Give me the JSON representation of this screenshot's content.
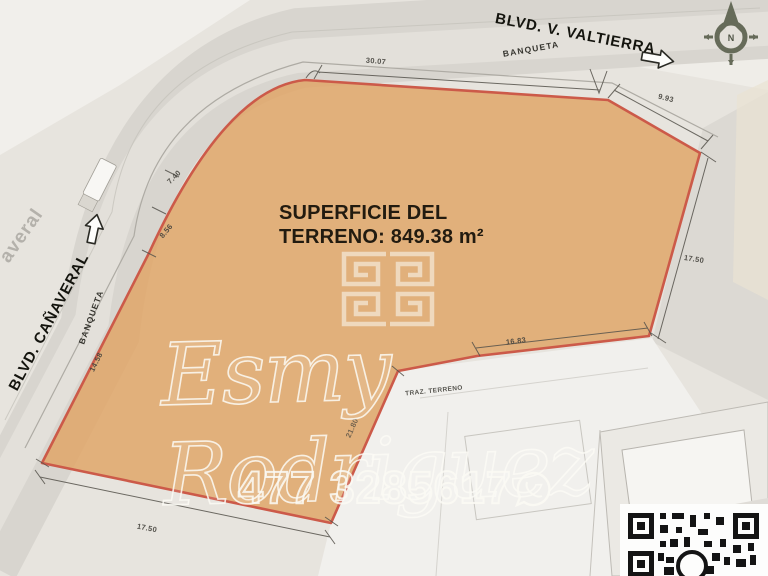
{
  "map": {
    "streets": {
      "valtierra": "BLVD. V. VALTIERRA",
      "canaveral": "BLVD. CAÑAVERAL",
      "banqueta_top": "BANQUETA",
      "banqueta_left": "BANQUETA",
      "faded_fragment": "averal"
    },
    "parcel": {
      "area_line1": "SUPERFICIE DEL",
      "area_line2": "TERRENO: 849.38 m²",
      "note": "TRAZ. TERRENO",
      "fill_color": "#e0a668",
      "boundary_color": "#cc5a49"
    },
    "dimensions": {
      "top_curve": "30.07",
      "top_right": "9.93",
      "right_side": "17.50",
      "inner_top": "16.83",
      "inner_left": "21.80",
      "bottom": "17.50",
      "left_lower": "14.58",
      "left_mid": "8.56",
      "left_upper": "7.40"
    },
    "compass_label": "N"
  },
  "watermark": {
    "name": "Esmy Rodriguez",
    "phone": "477 3285617"
  }
}
